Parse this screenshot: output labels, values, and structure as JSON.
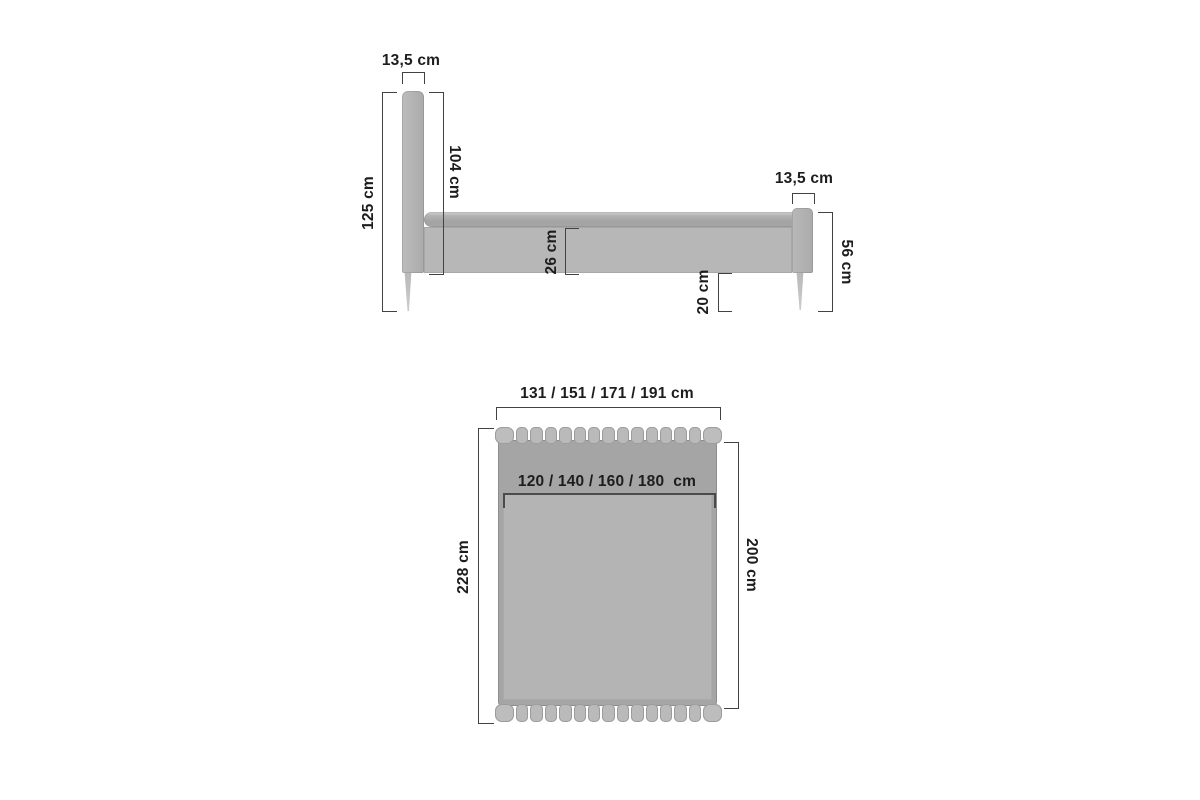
{
  "drawing": {
    "type": "furniture-dimension-diagram",
    "subject": "upholstered bed frame, side view and top view"
  },
  "side_view": {
    "labels": {
      "headboard_thickness": "13,5 cm",
      "total_height": "125 cm",
      "headboard_height": "104 cm",
      "frame_height": "26 cm",
      "floor_clearance": "20 cm",
      "footboard_thickness": "13,5 cm",
      "footboard_height": "56 cm"
    }
  },
  "top_view": {
    "labels": {
      "outer_width": "131 / 151 / 171 / 191 cm",
      "mattress_width": "120 / 140 / 160 / 180  cm",
      "outer_length": "228 cm",
      "mattress_length": "200 cm"
    }
  },
  "palette": {
    "frame_gray": "#a5a5a5",
    "mattress_gray": "#b4b4b4",
    "upholstery_gray": "#bababa",
    "rail_gray": "#b7b7b7",
    "dimension_line": "#424242",
    "label_text": "#1d1d1d",
    "background": "#ffffff"
  }
}
